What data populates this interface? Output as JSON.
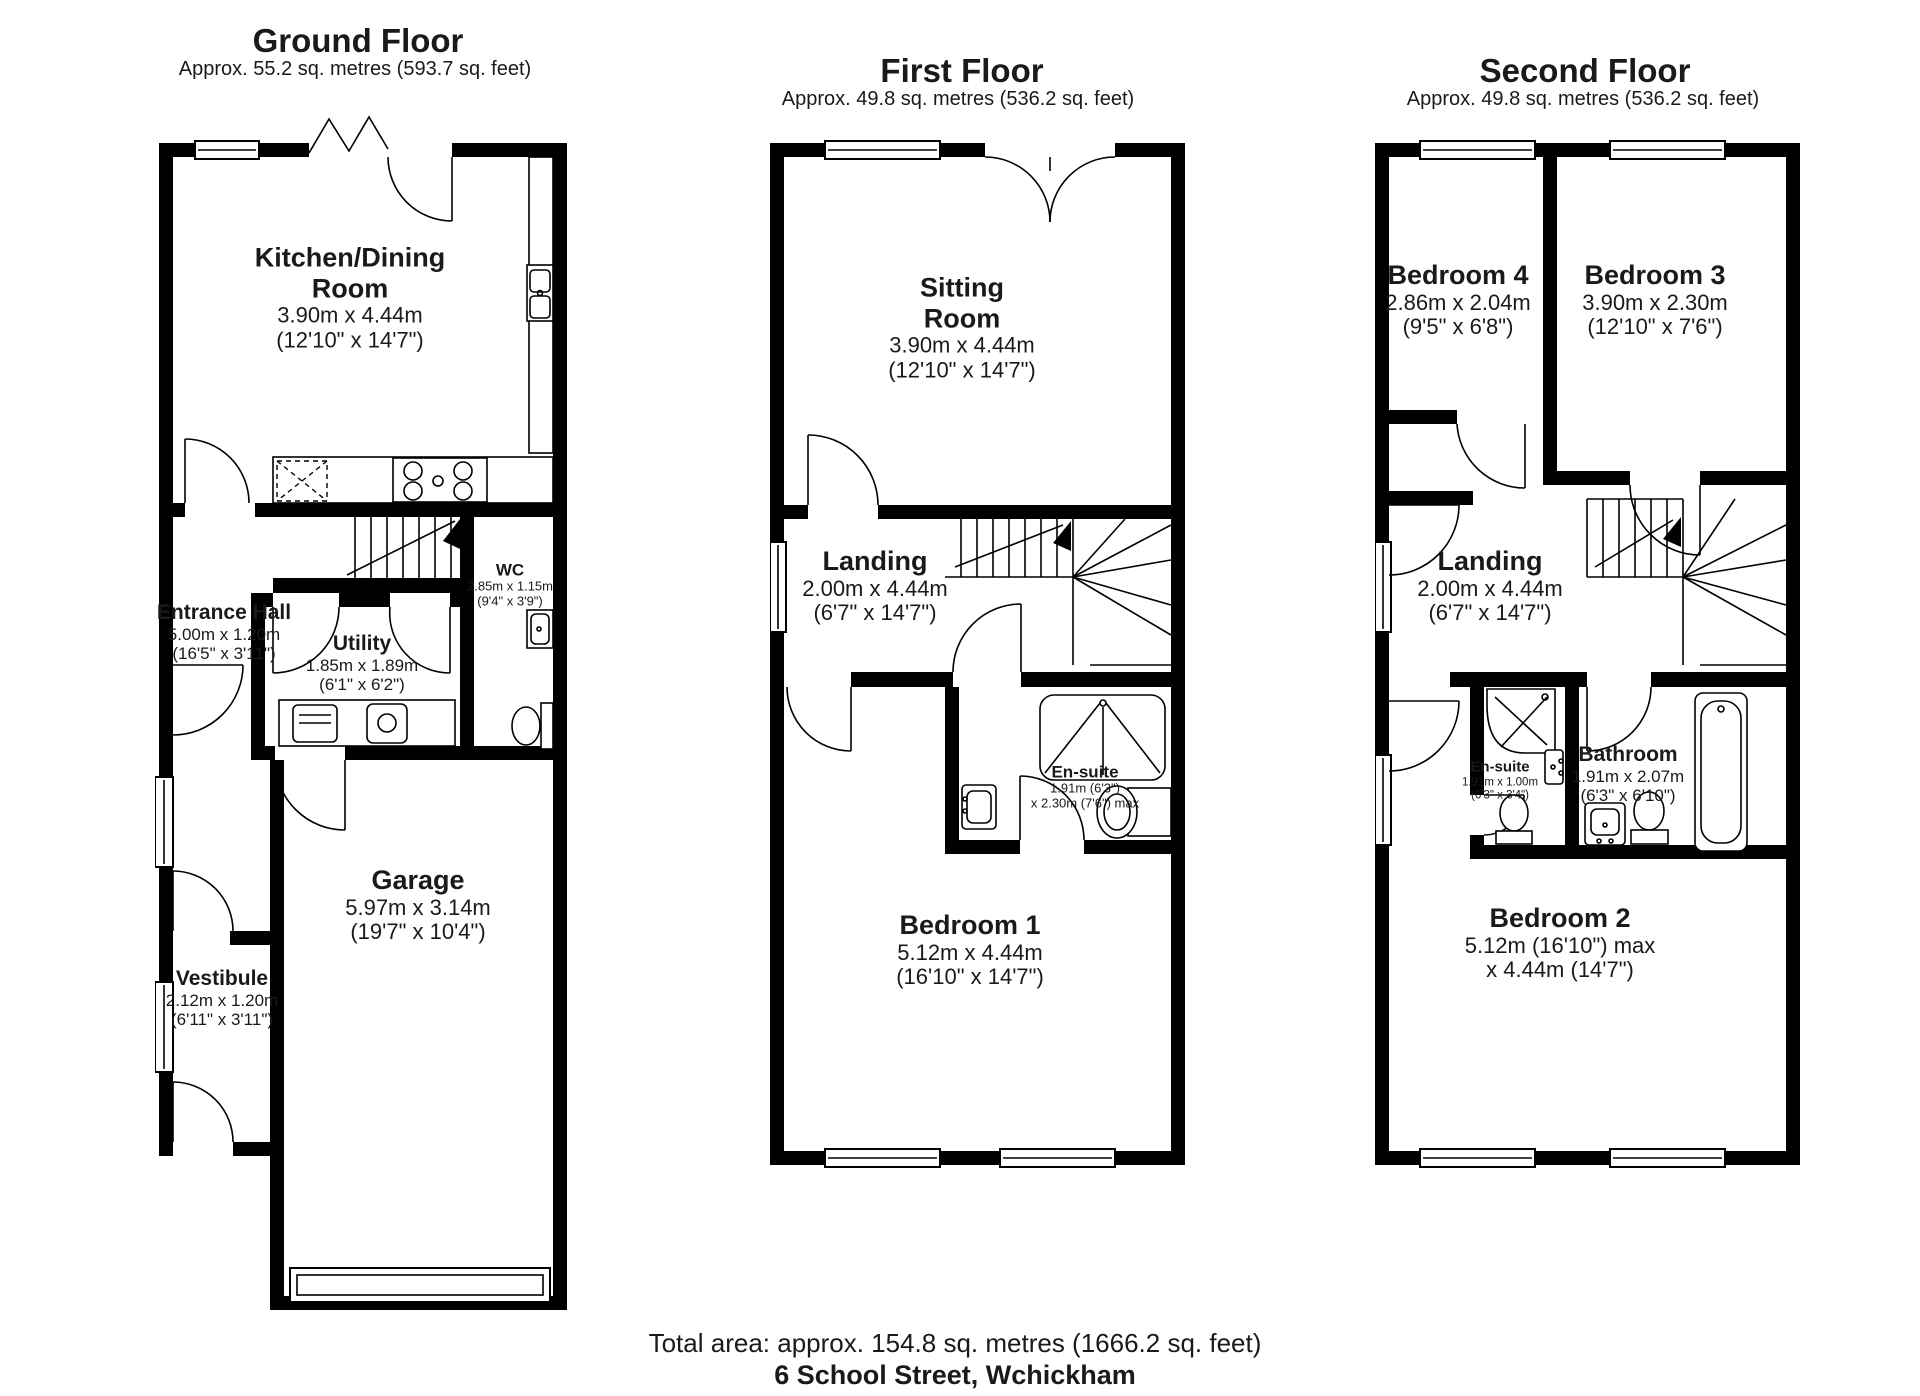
{
  "document": {
    "footer": {
      "total_area": "Total area: approx. 154.8 sq. metres (1666.2 sq. feet)",
      "address": "6 School Street, Wchickham"
    }
  },
  "floors": {
    "ground": {
      "title": "Ground Floor",
      "subtitle": "Approx. 55.2 sq. metres (593.7 sq. feet)",
      "rooms": {
        "kitchen": {
          "name": "Kitchen/Dining Room",
          "metric": "3.90m x 4.44m",
          "imperial": "(12'10\" x 14'7\")"
        },
        "wc": {
          "name": "WC",
          "metric": "2.85m x 1.15m",
          "imperial": "(9'4\" x 3'9\")"
        },
        "entrance": {
          "name": "Entrance Hall",
          "metric": "5.00m x 1.20m",
          "imperial": "(16'5\" x 3'11\")"
        },
        "utility": {
          "name": "Utility",
          "metric": "1.85m x 1.89m",
          "imperial": "(6'1\" x 6'2\")"
        },
        "garage": {
          "name": "Garage",
          "metric": "5.97m x 3.14m",
          "imperial": "(19'7\" x 10'4\")"
        },
        "vestibule": {
          "name": "Vestibule",
          "metric": "2.12m x 1.20m",
          "imperial": "(6'11\" x 3'11\")"
        }
      }
    },
    "first": {
      "title": "First Floor",
      "subtitle": "Approx. 49.8 sq. metres (536.2 sq. feet)",
      "rooms": {
        "sitting": {
          "name": "Sitting Room",
          "metric": "3.90m x 4.44m",
          "imperial": "(12'10\" x 14'7\")"
        },
        "landing": {
          "name": "Landing",
          "metric": "2.00m x 4.44m",
          "imperial": "(6'7\" x 14'7\")"
        },
        "ensuite": {
          "name": "En-suite",
          "metric": "1.91m (6'3\")",
          "imperial": "x 2.30m (7'6\") max"
        },
        "bedroom1": {
          "name": "Bedroom 1",
          "metric": "5.12m x 4.44m",
          "imperial": "(16'10\" x 14'7\")"
        }
      }
    },
    "second": {
      "title": "Second Floor",
      "subtitle": "Approx. 49.8 sq. metres (536.2 sq. feet)",
      "rooms": {
        "bedroom4": {
          "name": "Bedroom 4",
          "metric": "2.86m x 2.04m",
          "imperial": "(9'5\" x 6'8\")"
        },
        "bedroom3": {
          "name": "Bedroom 3",
          "metric": "3.90m x 2.30m",
          "imperial": "(12'10\" x 7'6\")"
        },
        "landing": {
          "name": "Landing",
          "metric": "2.00m x 4.44m",
          "imperial": "(6'7\" x 14'7\")"
        },
        "ensuite": {
          "name": "En-suite",
          "metric": "1.91m x 1.00m",
          "imperial": "(6'3\" x 3'4\")"
        },
        "bathroom": {
          "name": "Bathroom",
          "metric": "1.91m x 2.07m",
          "imperial": "(6'3\" x 6'10\")"
        },
        "bedroom2": {
          "name": "Bedroom 2",
          "metric": "5.12m (16'10\") max",
          "imperial": "x 4.44m (14'7\")"
        }
      }
    }
  }
}
